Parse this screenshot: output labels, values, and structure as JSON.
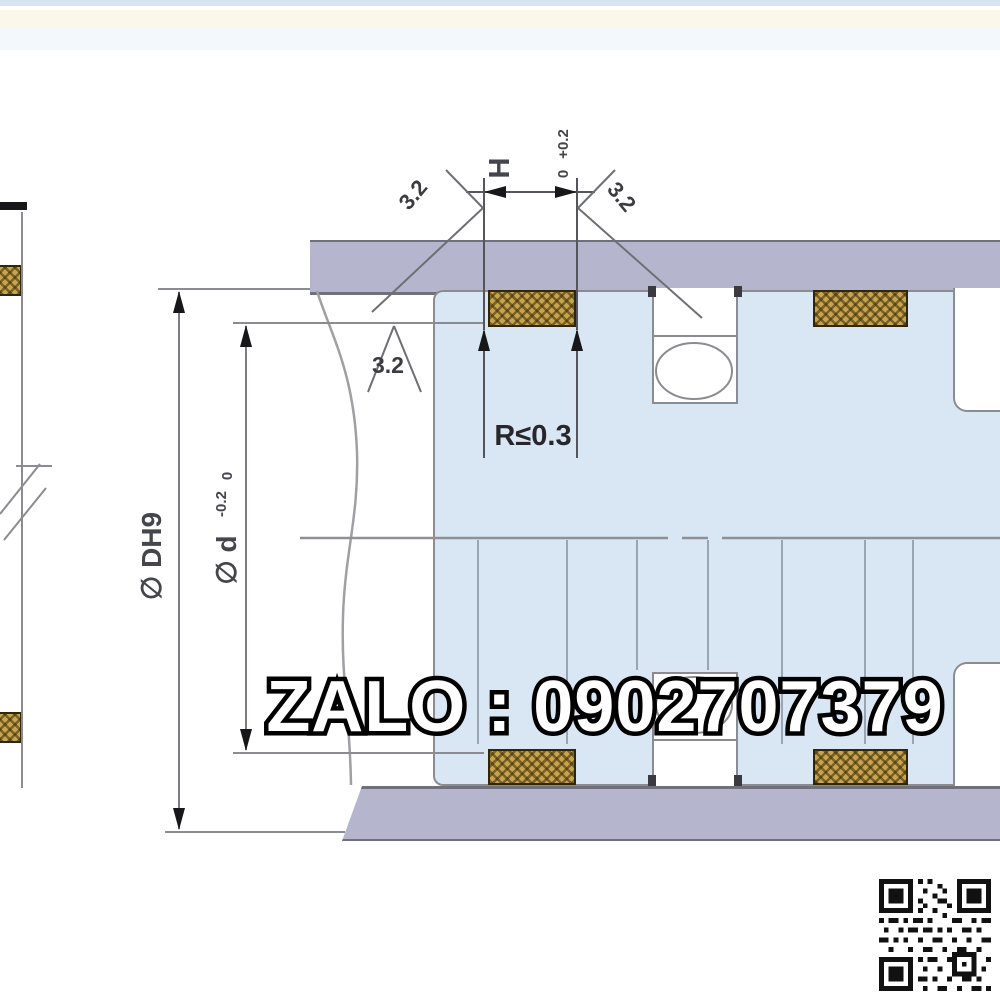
{
  "background": {
    "top_strip_color": "#d6e5f1",
    "cream_strip_color": "#fbf8ea",
    "page_color": "#ffffff"
  },
  "drawing": {
    "labels": {
      "groove_width": "H",
      "groove_width_tol_upper": "+0.2",
      "groove_width_tol_lower": "0",
      "bore_diameter": "∅ DH9",
      "groove_diameter": "∅ d",
      "groove_diameter_tol_upper": "0",
      "groove_diameter_tol_lower": "-0.2",
      "corner_radius": "R≤0.3",
      "roughness_left_wall": "3.2",
      "roughness_right_wall": "3.2",
      "roughness_groove_root": "3.2"
    },
    "colors": {
      "cylinder_wall": "#b5b6ce",
      "cylinder_wall_edge": "#6f707a",
      "piston_body": "#d9e7f4",
      "outline": "#8b8c92",
      "seal_gold": "#c9a44e",
      "seal_hatch_dark": "#3a2c06",
      "dimension_text": "#45464c"
    }
  },
  "watermark": {
    "text": "ZALO : 0902707379"
  },
  "footer": {
    "qr_icon": "qr-code"
  }
}
